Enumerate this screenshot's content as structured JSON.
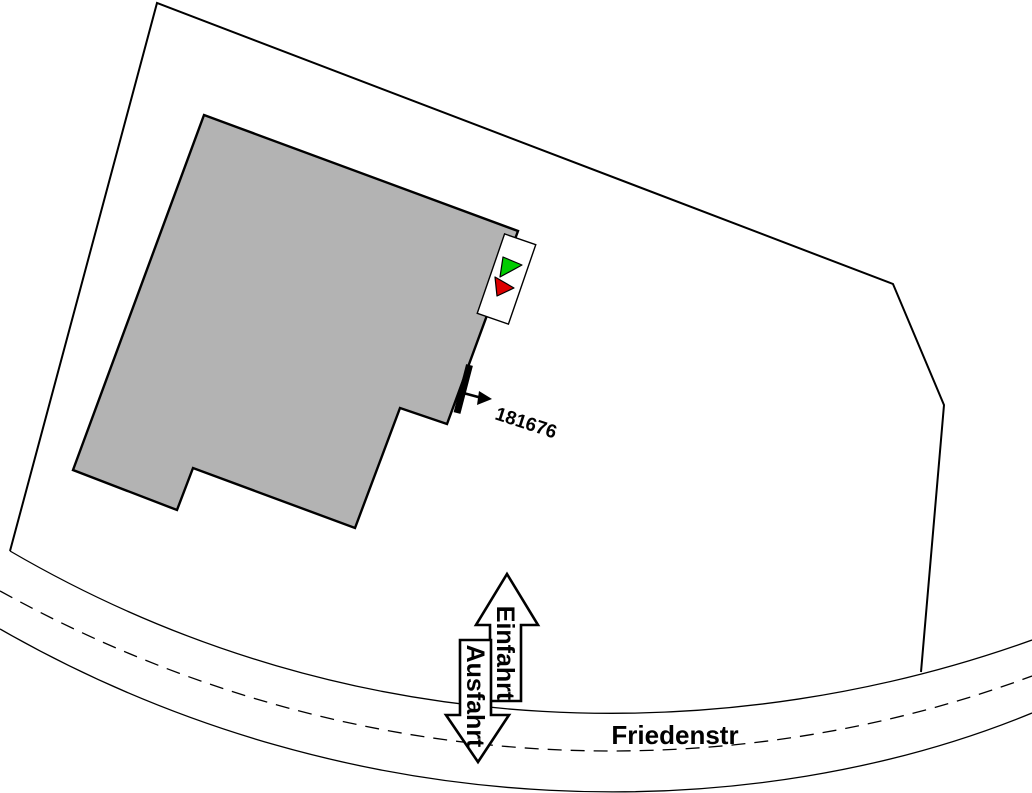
{
  "plan": {
    "street": "Friedenstr",
    "entrance": "Einfahrt",
    "exit": "Ausfahrt",
    "object_number": "181676"
  },
  "colors": {
    "building_fill": "#b3b3b3",
    "marker_green": "#00cc00",
    "marker_red": "#dd0000",
    "line": "#000000",
    "background": "#ffffff"
  }
}
